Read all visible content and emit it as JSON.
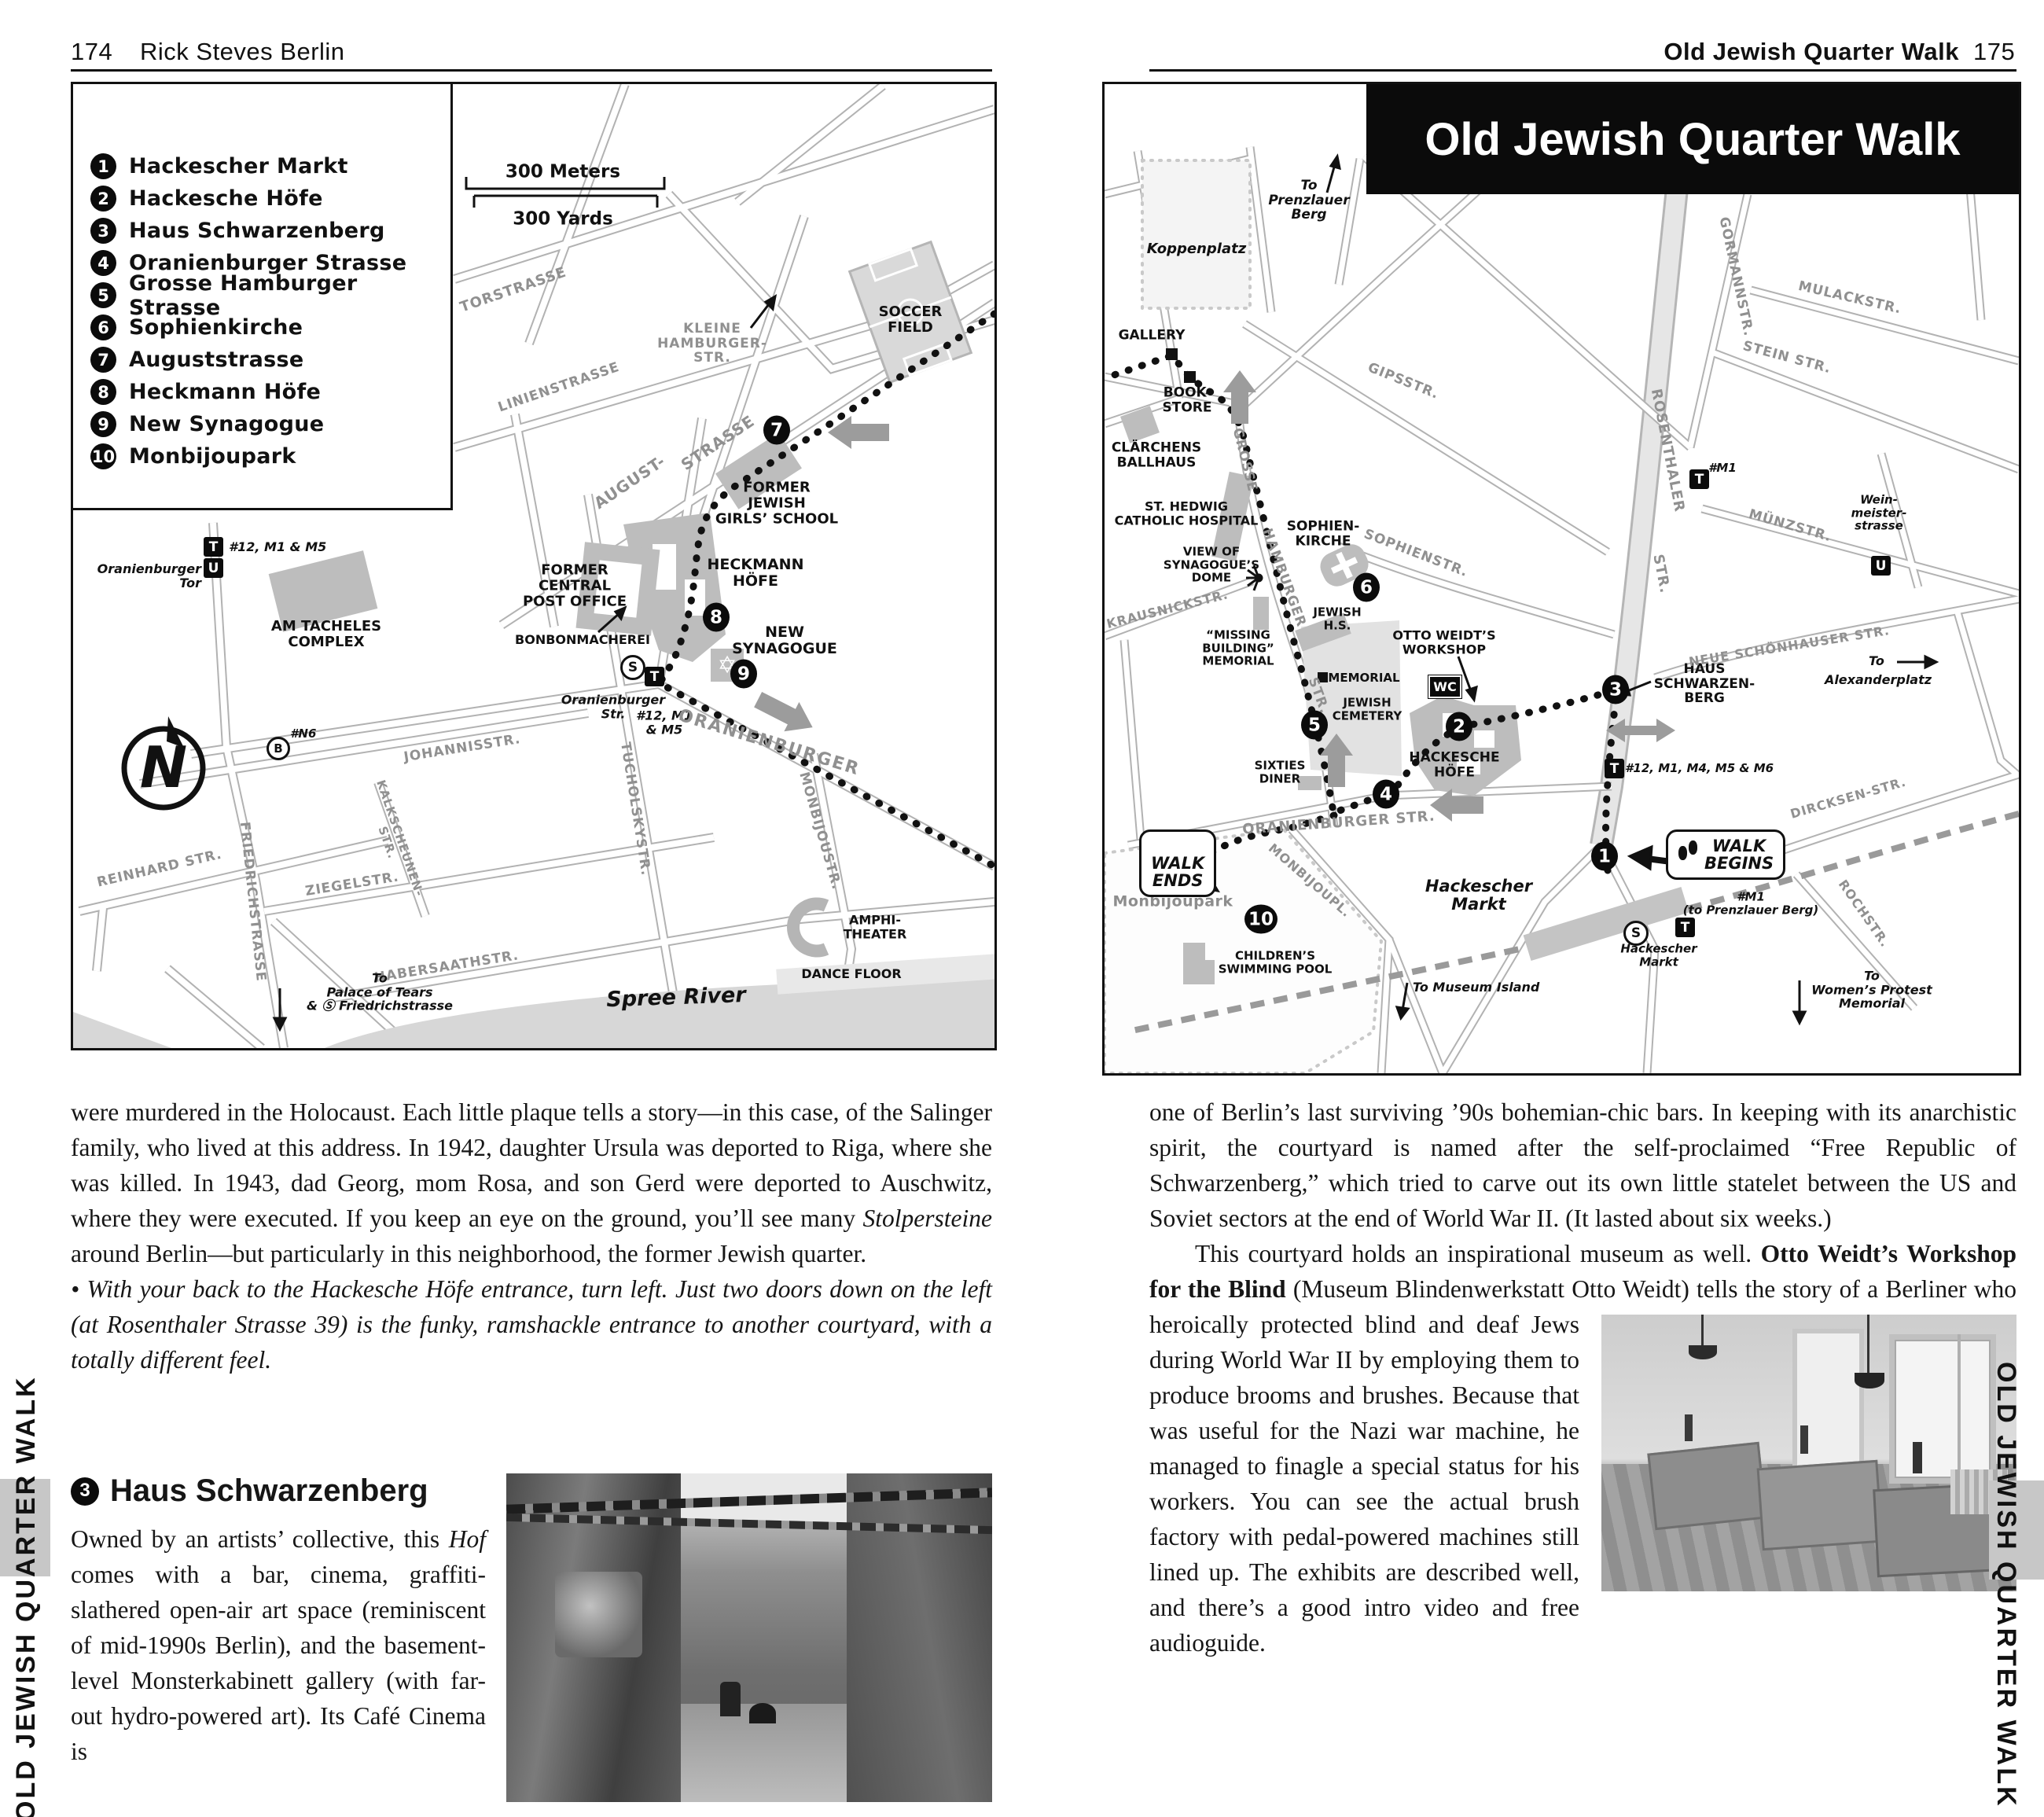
{
  "sidebar_tab_text": "OLD JEWISH QUARTER WALK",
  "header_left": {
    "page": "174",
    "title": "Rick Steves Berlin"
  },
  "header_right": {
    "title": "Old Jewish Quarter Walk",
    "page": "175"
  },
  "icons": {
    "tram": "T",
    "ubahn": "U",
    "sbahn": "S",
    "bus": "B",
    "wc": "WC",
    "compass_n": "N"
  },
  "map_left": {
    "legend": [
      {
        "n": "1",
        "label": "Hackescher Markt"
      },
      {
        "n": "2",
        "label": "Hackesche Höfe"
      },
      {
        "n": "3",
        "label": "Haus Schwarzenberg"
      },
      {
        "n": "4",
        "label": "Oranienburger Strasse"
      },
      {
        "n": "5",
        "label": "Grosse Hamburger Strasse"
      },
      {
        "n": "6",
        "label": "Sophienkirche"
      },
      {
        "n": "7",
        "label": "Auguststrasse"
      },
      {
        "n": "8",
        "label": "Heckmann Höfe"
      },
      {
        "n": "9",
        "label": "New Synagogue"
      },
      {
        "n": "10",
        "label": "Monbijoupark"
      }
    ],
    "scale_meters": "300 Meters",
    "scale_yards": "300 Yards",
    "markers": {
      "seven": "7",
      "eight": "8",
      "nine": "9"
    },
    "labels": {
      "torstrasse": "TORSTRASSE",
      "linienstrasse": "LINIENSTRASSE",
      "kleine_hamburger": "KLEINE\nHAMBURGER-\nSTR.",
      "soccer_field": "SOCCER\nFIELD",
      "august": "AUGUST-",
      "august_strasse": "STRASSE",
      "former_school": "FORMER\nJEWISH\nGIRLS’ SCHOOL",
      "heckmann_hofe": "HECKMANN\nHÖFE",
      "former_post": "FORMER\nCENTRAL\nPOST OFFICE",
      "bonbonmacherei": "BONBONMACHEREI",
      "new_synagogue": "NEW\nSYNAGOGUE",
      "stop_oranienburger": "Oranienburger\nStr.",
      "stop_tram_lines": "#12, M1\n& M5",
      "oranienburger_street": "ORANIENBURGER",
      "tor_tram_lines": "#12, M1 & M5",
      "oranienburger_tor": "Oranienburger Tor",
      "am_tacheles": "AM TACHELES\nCOMPLEX",
      "bus_n6": "#N6",
      "johannisstr": "JOHANNISSTR.",
      "kalkscheunenstr": "KALKSCHEUNEN-\nSTR.",
      "tucholskystr": "TUCHOLSKYSTR.",
      "monbijoustr": "MONBIJOUSTR.",
      "ziegelstr": "ZIEGELSTR.",
      "reinhard_str": "REINHARD STR.",
      "friedrichstrasse": "FRIEDRICHSTRASSE",
      "habersaathstr": "HABERSAATHSTR.",
      "to_palace": "To\nPalace of Tears\n& Ⓢ Friedrichstrasse",
      "spree_river": "Spree  River",
      "amphitheater": "AMPHI-\nTHEATER",
      "dance_floor": "DANCE FLOOR"
    }
  },
  "map_right": {
    "title": "Old Jewish Quarter Walk",
    "markers": {
      "one": "1",
      "two": "2",
      "three": "3",
      "four": "4",
      "five": "5",
      "six": "6",
      "ten": "10"
    },
    "labels": {
      "to_prenzlauer": "To\nPrenzlauer\nBerg",
      "koppenplatz": "Koppenplatz",
      "gallery": "GALLERY",
      "bookstore": "BOOK-\nSTORE",
      "clarchens": "CLÄRCHENS\nBALLHAUS",
      "gipsstr": "GIPSSTR.",
      "gormannstr": "GORMANNSTR.",
      "mulackstr": "MULACKSTR.",
      "steinstr": "STEIN  STR.",
      "rosenthaler": "ROSENTHALER",
      "rosenthaler_str": "STR.",
      "m1": "#M1",
      "munzstr": "MÜNZSTR.",
      "weinmeister": "Wein-\nmeister-\nstrasse",
      "st_hedwig": "ST. HEDWIG\nCATHOLIC HOSPITAL",
      "view_dome": "VIEW OF\nSYNAGOGUE’S\nDOME",
      "krausnickstr": "KRAUSNICKSTR.",
      "grosse": "GROSSE",
      "hamburger": "HAMBURGER",
      "gh_str": "STR.",
      "sophienkirche": "SOPHIEN-\nKIRCHE",
      "sophienstr": "SOPHIENSTR.",
      "missing_building": "“MISSING\nBUILDING”\nMEMORIAL",
      "jewish_hs": "JEWISH\nH.S.",
      "memorial": "MEMORIAL",
      "jewish_cemetery": "JEWISH\nCEMETERY",
      "otto_weidt": "OTTO WEIDT’S\nWORKSHOP",
      "haus_schwarzenberg": "HAUS\nSCHWARZEN-\nBERG",
      "neue_schonhauser": "NEUE SCHÖNHAUSER STR.",
      "to_alexanderplatz_to": "To",
      "to_alexanderplatz": "Alexanderplatz",
      "hackesche_hofe": "HACKESCHE\nHÖFE",
      "tram_lines_hm": "#12, M1, M4, M5 & M6",
      "sixties_diner": "SIXTIES\nDINER",
      "oranienburger_str": "ORANIENBURGER STR.",
      "dircksen_str": "DIRCKSEN-STR.",
      "walk_ends": "WALK\nENDS",
      "monbijoupark": "Monbijoupark",
      "childrens_pool": "CHILDREN’S\nSWIMMING POOL",
      "monbijoupl": "MONBIJOUPL.",
      "hackescher_markt": "Hackescher\nMarkt",
      "walk_begins": "WALK\nBEGINS",
      "m1_prenzlauer": "#M1\n(to Prenzlauer Berg)",
      "hackescher_markt_station": "Hackescher\nMarkt",
      "to_museum_island": "To Museum Island",
      "rochstr": "ROCHSTR.",
      "to_womens": "To\nWomen’s Protest\nMemorial"
    }
  },
  "body_left": {
    "para1_a": "were murdered in the Holocaust. Each little plaque tells a story—in this case, of the Salinger family, who lived at this address. In 1942, daughter Ursula was deported to Riga, where she was killed. In 1943, dad Georg, mom Rosa, and son Gerd were deported to Auschwitz, where they were executed. If you keep an eye on the ground, you’ll see many ",
    "para1_em": "Stolpersteine",
    "para1_b": " around Berlin—but particularly in this neighborhood, the former Jewish quarter.",
    "bullet": "•",
    "note": " With your back to the Hackesche Höfe entrance, turn left. Just two doors down on the left (at Rosenthaler Strasse 39) is the funky, ramshackle entrance to another courtyard, with a totally different feel.",
    "heading_num": "3",
    "heading": "Haus Schwarzenberg",
    "para2_a": "Owned by an artists’ collective, this ",
    "para2_em": "Hof",
    "para2_b": " comes with a bar, cinema, graffiti-slathered open-air art space (reminiscent of mid-1990s Berlin), and the basement-level Monsterkabinett gallery (with far-out hydro-powered art). Its Café Cinema is"
  },
  "body_right": {
    "para1": "one of Berlin’s last surviving ’90s bohemian-chic bars. In keeping with its anarchistic spirit, the courtyard is named after the self-proclaimed “Free Republic of Schwarzenberg,” which tried to carve out its own little statelet between the US and Soviet sectors at the end of World War II. (It lasted about six weeks.)",
    "para2_a": "This courtyard holds an inspirational museum as well. ",
    "para2_bold": "Otto Weidt’s Workshop for the Blind",
    "para2_b": " (Museum Blindenwerkstatt Otto Weidt) tells the story of a Berliner who heroically protected ",
    "para2_c": "blind and deaf Jews during World War II by employing them to produce brooms and brushes. Because that was useful for the Nazi war machine, he managed to finagle a special status for his workers. You can see the actual brush factory with pedal-powered machines still lined up. The exhibits are described well, and there’s a good intro video and free audioguide."
  }
}
